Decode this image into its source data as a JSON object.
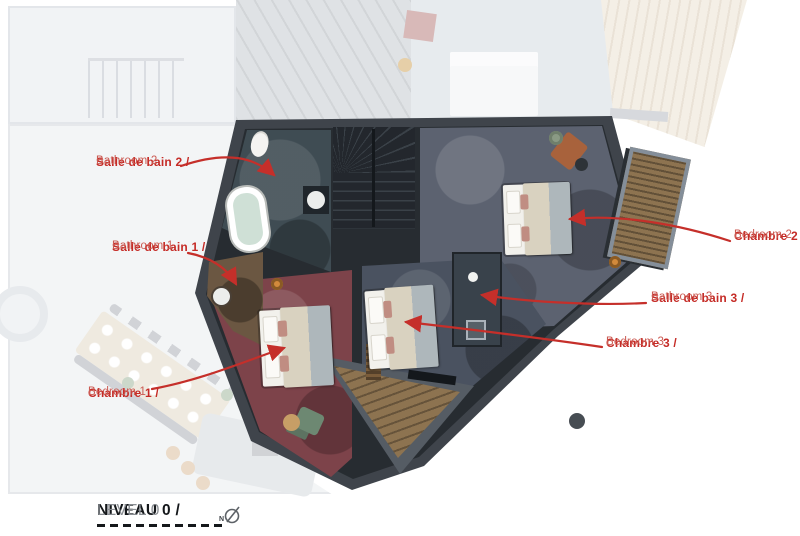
{
  "floorplan": {
    "annotations": [
      {
        "title": "Salle de bain 2 /",
        "subtitle": "Bathroom 2"
      },
      {
        "title": "Salle de bain 1 /",
        "subtitle": "Bathroom 1"
      },
      {
        "title": "Chambre 1 /",
        "subtitle": "Bedroom 1"
      },
      {
        "title": "Chambre 2 /",
        "subtitle": "Bedroom 2"
      },
      {
        "title": "Salle de bain 3 /",
        "subtitle": "Bathroom 3"
      },
      {
        "title": "Chambre 3 /",
        "subtitle": "Bedroom 3"
      }
    ],
    "level": {
      "primary": "NIVEAU 0 /",
      "secondary": "LEVEL 0"
    },
    "compass": {
      "north_label": "N"
    },
    "colors": {
      "red": "#c52b26",
      "wood": "#8d7350",
      "bedroom1_carpet": "#7d434a",
      "bedroom2_carpet": "#5c6270",
      "bedroom3_carpet": "#4a5260"
    }
  }
}
